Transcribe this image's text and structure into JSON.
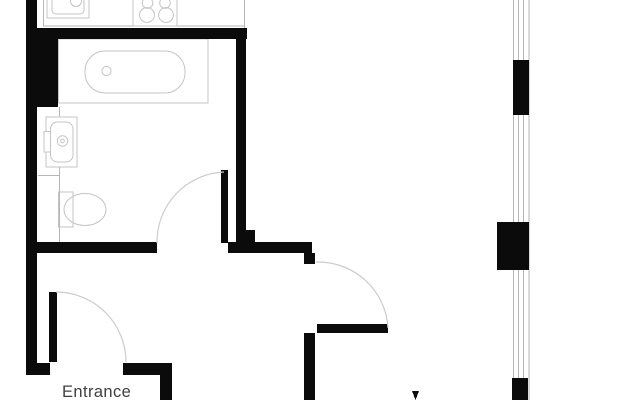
{
  "page": {
    "type": "apartment-floor-plan"
  },
  "labels": {
    "entrance": "Entrance"
  },
  "colors": {
    "wall": "#0b0b0b",
    "door_arc": "#cccccc",
    "fixture_line": "#c4c4c4",
    "detail_line": "#b6b6b6",
    "label_text": "#3f3f3f",
    "background": "#ffffff"
  },
  "fixtures": [
    {
      "name": "kitchen-sink"
    },
    {
      "name": "cooktop-four-burners"
    },
    {
      "name": "bathtub"
    },
    {
      "name": "washbasin"
    },
    {
      "name": "toilet"
    }
  ],
  "doors": [
    {
      "name": "bathroom-door"
    },
    {
      "name": "living-room-door"
    },
    {
      "name": "entrance-door"
    }
  ],
  "windows": [
    {
      "name": "right-exterior-window-wall",
      "glazing_segments": 3,
      "solid_piers": 3
    }
  ]
}
